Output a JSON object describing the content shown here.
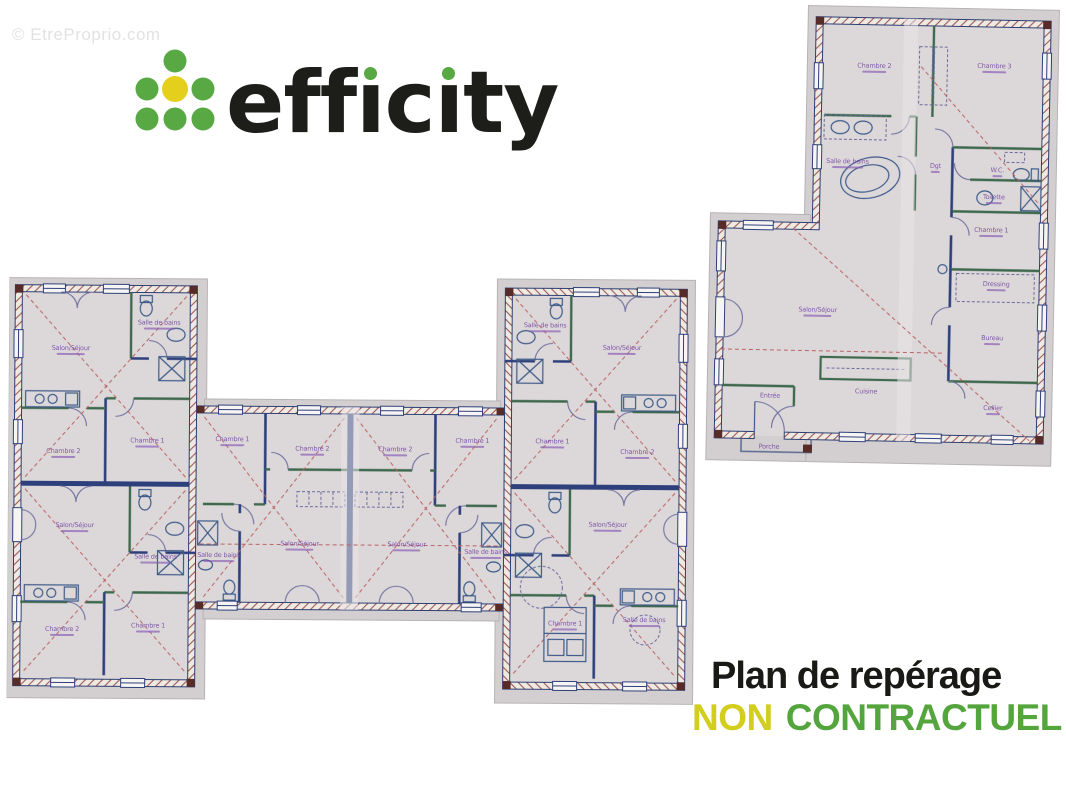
{
  "watermark": {
    "text": "© EtreProprio.com"
  },
  "logo": {
    "text": "efficity",
    "dot_green": "#58a844",
    "dot_yellow": "#e5cf1d",
    "ink": "#1d1d1a"
  },
  "caption": {
    "line1": "Plan de repérage",
    "word_yellow": "NON",
    "word_green": "CONTRACTUEL",
    "yellow": "#d3cd1d",
    "green": "#55a53e"
  },
  "plans": {
    "main": {
      "labels": [
        {
          "text": "Salon/Séjour",
          "x": 62,
          "y": 76
        },
        {
          "text": "Salle de bains",
          "x": 150,
          "y": 50
        },
        {
          "text": "Chambre 1",
          "x": 139,
          "y": 168
        },
        {
          "text": "Chambre 2",
          "x": 55,
          "y": 179
        },
        {
          "text": "Salon/Séjour",
          "x": 67,
          "y": 253
        },
        {
          "text": "Salle de bains",
          "x": 148,
          "y": 284
        },
        {
          "text": "Chambre 1",
          "x": 141,
          "y": 353
        },
        {
          "text": "Chambre 2",
          "x": 55,
          "y": 357
        },
        {
          "text": "Chambre 1",
          "x": 224,
          "y": 166
        },
        {
          "text": "Chambre 2",
          "x": 304,
          "y": 175
        },
        {
          "text": "Salon/Séjour",
          "x": 292,
          "y": 270
        },
        {
          "text": "Salle de bains",
          "x": 211,
          "y": 282
        },
        {
          "text": "Chambre 2",
          "x": 387,
          "y": 175
        },
        {
          "text": "Chambre 1",
          "x": 464,
          "y": 166
        },
        {
          "text": "Salon/Séjour",
          "x": 399,
          "y": 270
        },
        {
          "text": "Salle de bains",
          "x": 478,
          "y": 277
        },
        {
          "text": "Salle de bains",
          "x": 536,
          "y": 50
        },
        {
          "text": "Salon/Séjour",
          "x": 613,
          "y": 72
        },
        {
          "text": "Chambre 1",
          "x": 544,
          "y": 166
        },
        {
          "text": "Chambre 2",
          "x": 629,
          "y": 176
        },
        {
          "text": "Salon/Séjour",
          "x": 600,
          "y": 249
        },
        {
          "text": "Chambre 1",
          "x": 558,
          "y": 348
        },
        {
          "text": "Salle de bains",
          "x": 637,
          "y": 344
        }
      ]
    },
    "annex": {
      "labels": [
        {
          "text": "Chambre 2",
          "x": 168,
          "y": 62
        },
        {
          "text": "Chambre 3",
          "x": 288,
          "y": 60
        },
        {
          "text": "Salle de bains",
          "x": 143,
          "y": 158
        },
        {
          "text": "Dgt",
          "x": 231,
          "y": 161
        },
        {
          "text": "W.C.",
          "x": 293,
          "y": 164
        },
        {
          "text": "Toilette",
          "x": 290,
          "y": 191
        },
        {
          "text": "Chambre 1",
          "x": 288,
          "y": 224
        },
        {
          "text": "Dressing",
          "x": 294,
          "y": 278
        },
        {
          "text": "Bureau",
          "x": 291,
          "y": 332
        },
        {
          "text": "Cellier",
          "x": 293,
          "y": 402
        },
        {
          "text": "Cuisine",
          "x": 166,
          "y": 386,
          "bar": false
        },
        {
          "text": "Salon/Séjour",
          "x": 116,
          "y": 307
        },
        {
          "text": "Entrée",
          "x": 70,
          "y": 392,
          "bar": false
        },
        {
          "text": "Porche",
          "x": 70,
          "y": 443,
          "bar": false
        }
      ]
    }
  }
}
